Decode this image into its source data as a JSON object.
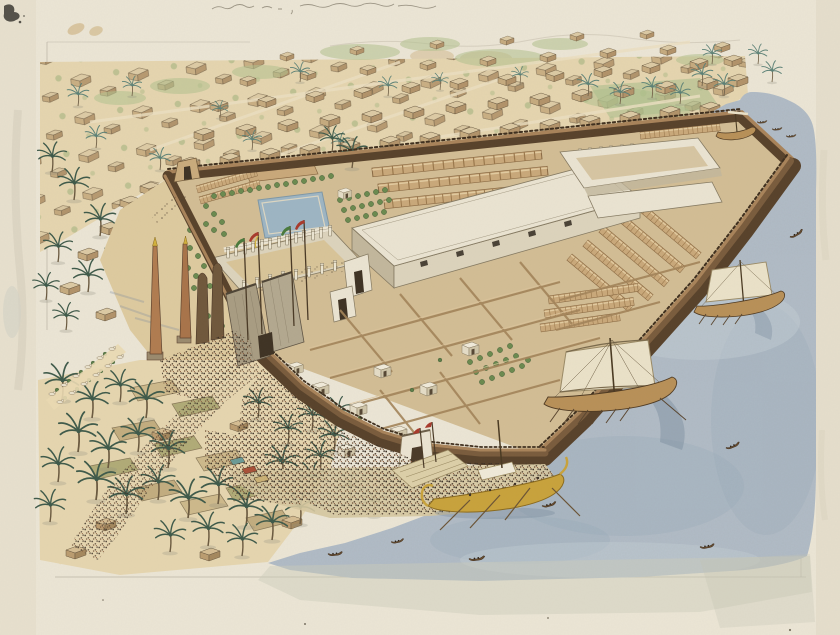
{
  "artwork": {
    "subject": "Bird's-eye watercolor reconstruction of an ancient Egyptian temple precinct beside the Nile, with walled enclosure, pylon, obelisks, sacred lake, quays, boats, palm groves and surrounding mud-brick town",
    "top_margin_annotation": "illegible handwritten pencil inscription"
  },
  "palette": {
    "paper": "#ebe5d5",
    "paperMargin": "#e3dcc9",
    "pencil": "#8f8878",
    "stain": "#d6c096",
    "sand": "#ddca9f",
    "sandLight": "#e5d5af",
    "road": "#ead9b2",
    "interior": "#d2bd94",
    "wallBrown": "#7a5c3d",
    "wallDark": "#58422b",
    "wallTop": "#a8835a",
    "stoneLight": "#eae3d1",
    "stoneMid": "#dcd3bc",
    "stoneShade": "#c2b79c",
    "stoneLine": "#857a62",
    "store": "#c9a87a",
    "storeRib": "#9a784c",
    "lake": "#9db5c3",
    "river": "#b1bcc7",
    "riverDark": "#93a7b6",
    "riverLight": "#c6d0d8",
    "gold": "#c8a23c",
    "sail": "#eae1c8",
    "sailShadow": "#6e8296",
    "flagRed": "#a83a2c",
    "flagGreen": "#4a7a3c",
    "flagYellow": "#d2b23e",
    "palmFrond": "#3f5a4a",
    "palmTrunk": "#6b5a40",
    "treeFill": "#6b8a4f",
    "houseTop": "#dccaa4",
    "houseFaceL": "#c6ab7f",
    "houseFaceR": "#b2936a",
    "houseLine": "#6b5a42",
    "obeliskGranite": "#b07c50",
    "crowdDark": "#3a3027"
  },
  "scene": {
    "setting": "temple complex on river bank, town behind, palm groves and fields in foreground",
    "temple_features": [
      "crenellated enclosure wall",
      "first pylon with four flag poles",
      "two obelisks",
      "colossal statues",
      "avenue of sphinxes",
      "peristyle court",
      "hypostyle hall with clerestory windows",
      "northeast colonnaded court",
      "sacred lake with tree garden",
      "vaulted storerooms",
      "white shrines in service courts",
      "riverside gate",
      "quay with stairs"
    ],
    "river_vessels": {
      "large_sailing_ships": 2,
      "ceremonial_barge": 1,
      "moored_boat_at_dock": 1,
      "small_rowing_boats": 10
    },
    "crowds": [
      "procession on road to pylon",
      "dense crowd along waterfront wall",
      "market crowd with striped awnings",
      "people inside courts"
    ],
    "surroundings": [
      "flat-roofed mud-brick town",
      "green garden plots",
      "palm groves",
      "cultivated fields",
      "distant hills on horizon"
    ]
  },
  "instances": {
    "palmsGrove": [
      [
        62,
        400,
        1.5
      ],
      [
        92,
        418,
        1.45
      ],
      [
        120,
        402,
        1.3
      ],
      [
        146,
        418,
        1.5
      ],
      [
        78,
        452,
        1.6
      ],
      [
        108,
        468,
        1.5
      ],
      [
        138,
        452,
        1.4
      ],
      [
        168,
        468,
        1.5
      ],
      [
        96,
        500,
        1.6
      ],
      [
        126,
        514,
        1.5
      ],
      [
        158,
        500,
        1.4
      ],
      [
        188,
        518,
        1.55
      ],
      [
        218,
        504,
        1.5
      ],
      [
        246,
        526,
        1.5
      ],
      [
        208,
        546,
        1.35
      ],
      [
        170,
        552,
        1.3
      ],
      [
        242,
        556,
        1.3
      ],
      [
        272,
        540,
        1.4
      ],
      [
        300,
        524,
        1.3
      ],
      [
        58,
        482,
        1.4
      ],
      [
        50,
        522,
        1.3
      ],
      [
        282,
        480,
        1.4
      ],
      [
        312,
        494,
        1.3
      ],
      [
        334,
        452,
        1.3
      ],
      [
        312,
        430,
        1.2
      ],
      [
        350,
        502,
        1.2
      ],
      [
        374,
        516,
        1.1
      ],
      [
        258,
        418,
        1.2
      ],
      [
        288,
        444,
        1.2
      ],
      [
        320,
        472,
        1.25
      ],
      [
        338,
        424,
        1.1
      ]
    ],
    "palmsVillage": [
      [
        52,
        172,
        1.2
      ],
      [
        74,
        200,
        1.3
      ],
      [
        100,
        236,
        1.3
      ],
      [
        58,
        262,
        1.2
      ],
      [
        88,
        292,
        1.3
      ],
      [
        118,
        268,
        1.1
      ],
      [
        46,
        300,
        1.1
      ],
      [
        130,
        302,
        1.0
      ],
      [
        66,
        330,
        1.1
      ]
    ],
    "palmsTown": [
      [
        78,
        106,
        0.9
      ],
      [
        96,
        148,
        0.9
      ],
      [
        132,
        96,
        0.8
      ],
      [
        160,
        170,
        0.9
      ],
      [
        252,
        150,
        0.8
      ],
      [
        300,
        82,
        0.8
      ],
      [
        388,
        96,
        0.8
      ],
      [
        588,
        96,
        0.9
      ],
      [
        620,
        104,
        0.9
      ],
      [
        652,
        98,
        0.85
      ],
      [
        702,
        86,
        0.9
      ],
      [
        724,
        96,
        0.9
      ],
      [
        758,
        64,
        0.8
      ],
      [
        772,
        82,
        0.85
      ],
      [
        712,
        64,
        0.8
      ],
      [
        340,
        152,
        0.8
      ],
      [
        220,
        118,
        0.7
      ],
      [
        440,
        90,
        0.7
      ],
      [
        520,
        84,
        0.7
      ],
      [
        680,
        104,
        0.85
      ]
    ],
    "palmsTemple": [
      [
        352,
        168,
        1.25
      ],
      [
        332,
        152,
        1.05
      ]
    ],
    "housesTown": [
      [
        180,
        157
      ],
      [
        220,
        153
      ],
      [
        260,
        148
      ],
      [
        300,
        144
      ],
      [
        340,
        140
      ],
      [
        380,
        136
      ],
      [
        420,
        132
      ],
      [
        460,
        127
      ],
      [
        500,
        123
      ],
      [
        540,
        119
      ],
      [
        580,
        115
      ],
      [
        620,
        111
      ],
      [
        660,
        106
      ],
      [
        700,
        102
      ],
      [
        194,
        128
      ],
      [
        236,
        124
      ],
      [
        278,
        119
      ],
      [
        320,
        114
      ],
      [
        362,
        110
      ],
      [
        404,
        106
      ],
      [
        446,
        101
      ],
      [
        488,
        97
      ],
      [
        530,
        93
      ],
      [
        572,
        89
      ],
      [
        614,
        85
      ],
      [
        656,
        81
      ],
      [
        698,
        77
      ],
      [
        728,
        74
      ],
      [
        210,
        100,
        0.9
      ],
      [
        258,
        96,
        0.9
      ],
      [
        306,
        91,
        0.9
      ],
      [
        354,
        87,
        0.9
      ],
      [
        402,
        82,
        0.9
      ],
      [
        450,
        78,
        0.9
      ],
      [
        498,
        74,
        0.9
      ],
      [
        546,
        70,
        0.9
      ],
      [
        594,
        66,
        0.9
      ],
      [
        642,
        62,
        0.9
      ],
      [
        690,
        58,
        0.9
      ],
      [
        724,
        55,
        0.9
      ],
      [
        240,
        76,
        0.8
      ],
      [
        300,
        70,
        0.8
      ],
      [
        360,
        65,
        0.8
      ],
      [
        420,
        60,
        0.8
      ],
      [
        480,
        56,
        0.8
      ],
      [
        540,
        52,
        0.8
      ],
      [
        600,
        48,
        0.8
      ],
      [
        660,
        45,
        0.8
      ],
      [
        714,
        42,
        0.8
      ],
      [
        280,
        52,
        0.7
      ],
      [
        350,
        46,
        0.7
      ],
      [
        430,
        40,
        0.7
      ],
      [
        500,
        36,
        0.7
      ],
      [
        570,
        32,
        0.7
      ],
      [
        640,
        30,
        0.7
      ],
      [
        120,
        196
      ],
      [
        100,
        222
      ],
      [
        78,
        248
      ],
      [
        128,
        232
      ],
      [
        150,
        212
      ],
      [
        60,
        282
      ],
      [
        96,
        308
      ],
      [
        140,
        182
      ]
    ],
    "housesGrove": [
      [
        152,
        428
      ],
      [
        244,
        472
      ],
      [
        96,
        518
      ],
      [
        282,
        516
      ],
      [
        200,
        548
      ],
      [
        66,
        546
      ],
      [
        230,
        420,
        0.9
      ]
    ],
    "tree": [
      [
        214,
        196
      ],
      [
        223,
        194
      ],
      [
        232,
        193
      ],
      [
        241,
        191
      ],
      [
        250,
        190
      ],
      [
        259,
        188
      ],
      [
        268,
        187
      ],
      [
        277,
        185
      ],
      [
        286,
        184
      ],
      [
        295,
        182
      ],
      [
        304,
        181
      ],
      [
        313,
        179
      ],
      [
        322,
        178
      ],
      [
        331,
        176
      ],
      [
        206,
        206
      ],
      [
        214,
        214
      ],
      [
        206,
        224
      ],
      [
        214,
        230
      ],
      [
        222,
        222
      ],
      [
        224,
        234
      ],
      [
        340,
        200
      ],
      [
        349,
        198
      ],
      [
        358,
        196
      ],
      [
        367,
        194
      ],
      [
        376,
        192
      ],
      [
        385,
        190
      ],
      [
        344,
        210
      ],
      [
        353,
        208
      ],
      [
        362,
        206
      ],
      [
        371,
        204
      ],
      [
        380,
        202
      ],
      [
        389,
        200
      ],
      [
        348,
        220
      ],
      [
        357,
        218
      ],
      [
        366,
        216
      ],
      [
        375,
        214
      ],
      [
        384,
        212
      ],
      [
        470,
        362
      ],
      [
        480,
        358
      ],
      [
        490,
        354
      ],
      [
        500,
        350
      ],
      [
        510,
        346
      ],
      [
        476,
        372
      ],
      [
        486,
        368
      ],
      [
        496,
        364
      ],
      [
        506,
        360
      ],
      [
        516,
        356
      ],
      [
        482,
        382
      ],
      [
        492,
        378
      ],
      [
        502,
        374
      ],
      [
        512,
        370
      ],
      [
        522,
        366
      ],
      [
        528,
        360
      ],
      [
        190,
        230
      ],
      [
        198,
        238
      ],
      [
        190,
        248
      ],
      [
        198,
        256
      ],
      [
        206,
        246
      ],
      [
        188,
        268
      ],
      [
        196,
        276
      ],
      [
        204,
        266
      ],
      [
        210,
        286
      ],
      [
        202,
        296
      ],
      [
        194,
        288
      ],
      [
        216,
        306
      ],
      [
        208,
        316
      ],
      [
        200,
        308
      ],
      [
        222,
        326
      ],
      [
        214,
        336
      ]
    ],
    "bush": [
      [
        320,
        398
      ],
      [
        360,
        418
      ],
      [
        412,
        390
      ],
      [
        440,
        360
      ],
      [
        57,
        390
      ],
      [
        69,
        381
      ],
      [
        81,
        372
      ],
      [
        93,
        363
      ],
      [
        105,
        354
      ],
      [
        65,
        398
      ],
      [
        77,
        389
      ],
      [
        89,
        380
      ],
      [
        101,
        371
      ],
      [
        113,
        362
      ]
    ],
    "shrine": [
      [
        312,
        382
      ],
      [
        350,
        402
      ],
      [
        390,
        426
      ],
      [
        374,
        364
      ],
      [
        420,
        382
      ],
      [
        462,
        342
      ],
      [
        288,
        362,
        0.9
      ],
      [
        338,
        444
      ],
      [
        338,
        188,
        0.8
      ]
    ],
    "sphinx": [
      [
        52,
        394
      ],
      [
        64,
        385
      ],
      [
        76,
        376
      ],
      [
        88,
        367
      ],
      [
        100,
        358
      ],
      [
        112,
        349
      ],
      [
        60,
        402
      ],
      [
        72,
        393
      ],
      [
        84,
        384
      ],
      [
        96,
        375
      ],
      [
        108,
        366
      ],
      [
        120,
        357
      ]
    ],
    "canoe": [
      [
        790,
        237,
        1,
        -30
      ],
      [
        726,
        448,
        1,
        -22
      ],
      [
        542,
        506,
        1,
        -15
      ],
      [
        469,
        559,
        1.1,
        -8
      ],
      [
        391,
        542,
        0.9,
        -12
      ],
      [
        700,
        547,
        1,
        -10
      ],
      [
        757,
        122,
        0.7,
        -5
      ],
      [
        772,
        129,
        0.7,
        -5
      ],
      [
        786,
        136,
        0.7,
        -5
      ],
      [
        328,
        554,
        1,
        -6
      ]
    ],
    "storeRow": [
      [
        372,
        168,
        1.7,
        -6,
        1.1
      ],
      [
        378,
        184,
        1.7,
        -6,
        1.1
      ],
      [
        384,
        200,
        1.4,
        -6,
        1.1
      ],
      [
        636,
        198,
        0.85,
        40,
        1
      ],
      [
        620,
        212,
        0.85,
        40,
        1
      ],
      [
        604,
        226,
        0.85,
        40,
        1
      ],
      [
        588,
        240,
        0.85,
        40,
        1
      ],
      [
        572,
        254,
        0.8,
        40,
        1
      ],
      [
        548,
        296,
        0.9,
        -8,
        1
      ],
      [
        544,
        310,
        0.9,
        -8,
        1
      ],
      [
        540,
        324,
        0.8,
        -8,
        1
      ],
      [
        640,
        132,
        0.8,
        -6,
        0.9
      ],
      [
        196,
        186,
        0.62,
        -16,
        0.9
      ],
      [
        199,
        197,
        0.62,
        -16,
        0.9
      ]
    ],
    "column": [
      [
        228,
        249
      ],
      [
        236,
        247
      ],
      [
        245,
        245
      ],
      [
        253,
        243
      ],
      [
        262,
        241
      ],
      [
        270,
        240
      ],
      [
        279,
        238
      ],
      [
        287,
        236
      ],
      [
        296,
        234
      ],
      [
        304,
        232
      ],
      [
        313,
        231
      ],
      [
        321,
        229
      ],
      [
        330,
        227
      ],
      [
        244,
        282
      ],
      [
        257,
        279
      ],
      [
        270,
        276
      ],
      [
        283,
        273
      ],
      [
        296,
        271
      ],
      [
        309,
        268
      ],
      [
        322,
        265
      ],
      [
        335,
        262
      ],
      [
        580,
        150,
        0.8
      ],
      [
        590,
        149,
        0.8
      ],
      [
        601,
        148,
        0.8
      ],
      [
        611,
        147,
        0.8
      ],
      [
        622,
        146,
        0.8
      ],
      [
        632,
        145,
        0.8
      ],
      [
        643,
        145,
        0.8
      ],
      [
        653,
        144,
        0.8
      ],
      [
        664,
        143,
        0.8
      ],
      [
        674,
        142,
        0.8
      ],
      [
        685,
        141,
        0.8
      ],
      [
        695,
        140,
        0.8
      ]
    ]
  }
}
